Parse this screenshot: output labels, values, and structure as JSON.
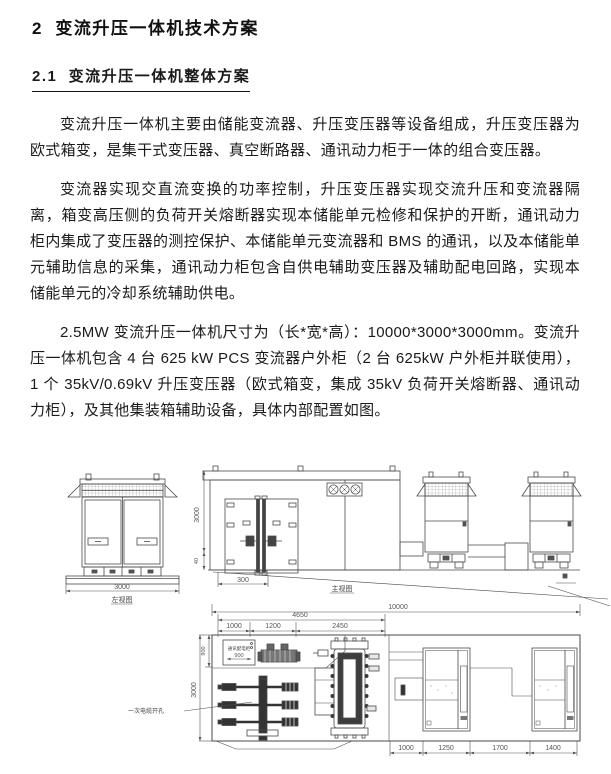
{
  "document": {
    "heading1": "2  变流升压一体机技术方案",
    "heading2": "2.1  变流升压一体机整体方案",
    "paragraphs": [
      "变流升压一体机主要由储能变流器、升压变压器等设备组成，升压变压器为欧式箱变，是集干式变压器、真空断路器、通讯动力柜于一体的组合变压器。",
      "变流器实现交直流变换的功率控制，升压变压器实现交流升压和变流器隔离，箱变高压侧的负荷开关熔断器实现本储能单元检修和保护的开断，通讯动力柜内集成了变压器的测控保护、本储能单元变流器和 BMS 的通讯，以及本储能单元辅助信息的采集，通讯动力柜包含自供电辅助变压器及辅助配电回路，实现本储能单元的冷却系统辅助供电。",
      "2.5MW 变流升压一体机尺寸为（长*宽*高）：10000*3000*3000mm。变流升压一体机包含 4 台 625 kW PCS 变流器户外柜（2 台 625kW 户外柜并联使用），1 个 35kV/0.69kV 升压变压器（欧式箱变，集成 35kV 负荷开关熔断器、通讯动力柜），及其他集装箱辅助设备，具体内部配置如图。"
    ]
  },
  "diagram": {
    "side_view": {
      "label": "左视图",
      "width_dim": "3000"
    },
    "front_view": {
      "label": "主视图",
      "height_dim": "3000",
      "base_dim": "40",
      "offset_dim": "300",
      "length_dim": "10000"
    },
    "plan_view": {
      "group_dim": "4650",
      "top_dims": [
        "1000",
        "1200",
        "2450"
      ],
      "depth_dim": "3000",
      "aux_depth_dim": "900",
      "aux_cabinet_label": "通讯配电柜",
      "aux_cabinet_width_dim": "900",
      "cable_hole_label": "一次电缆开孔",
      "bottom_dims": [
        "1000",
        "1250",
        "1700",
        "1400"
      ]
    }
  }
}
